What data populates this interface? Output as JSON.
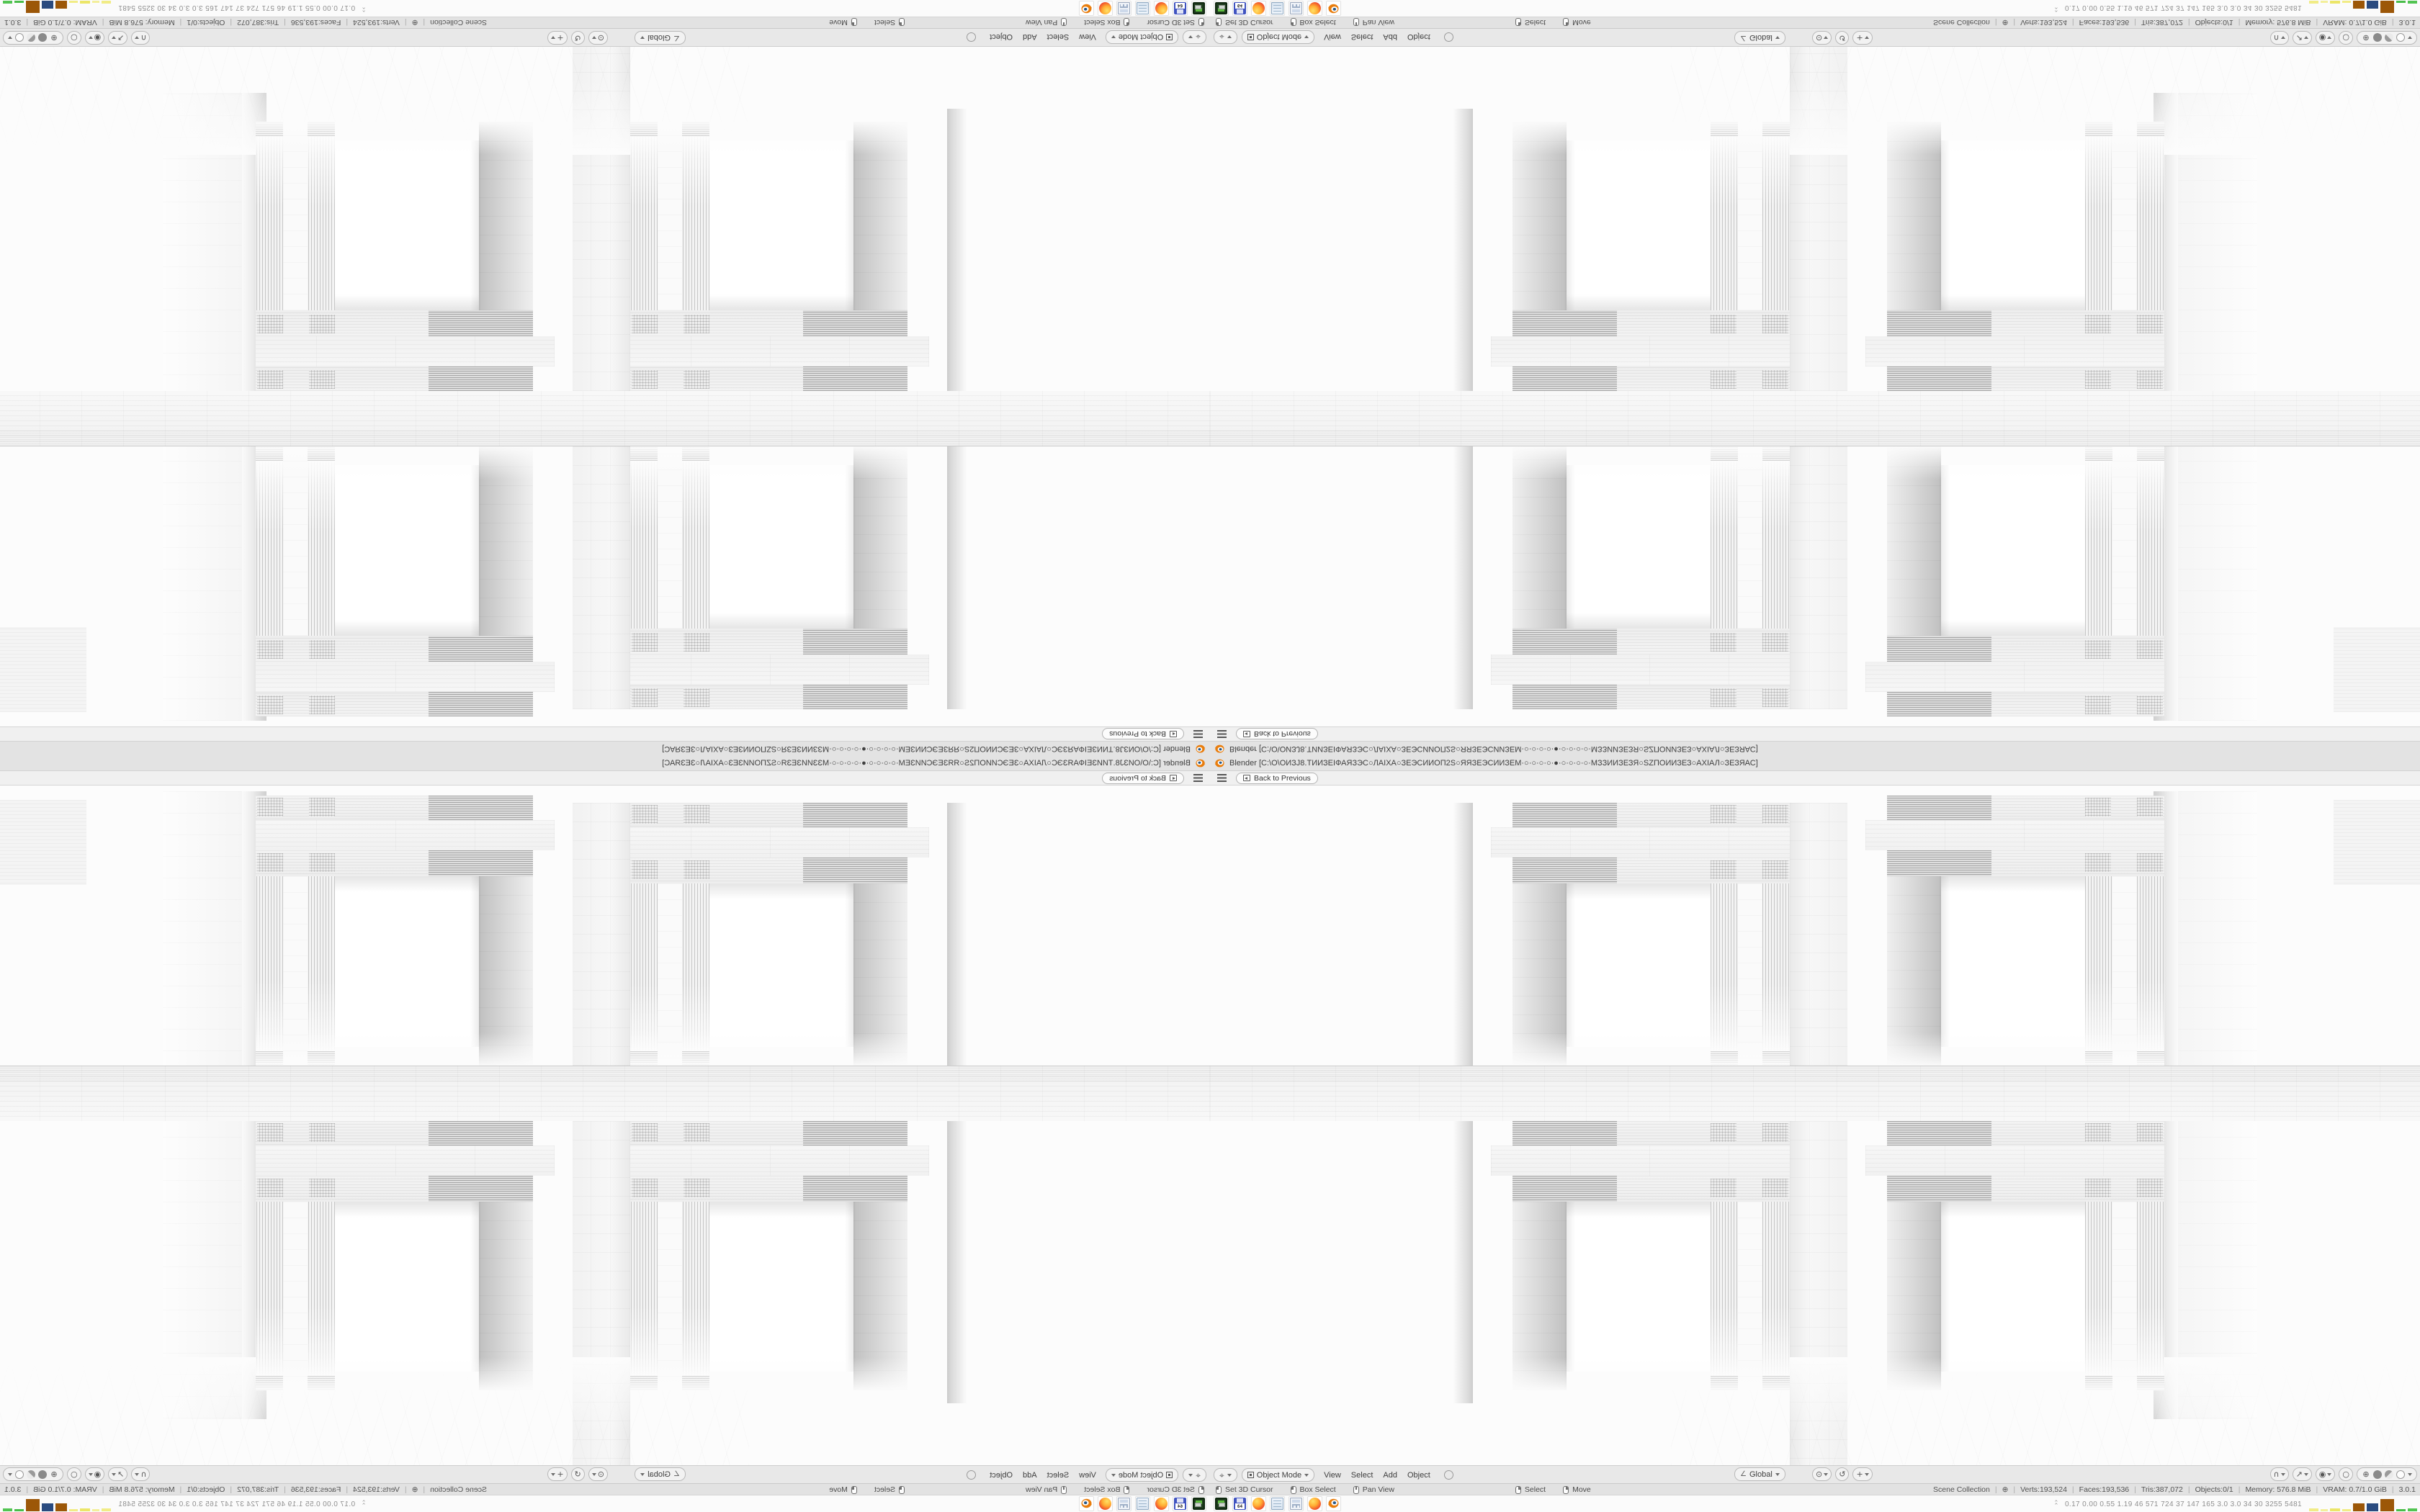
{
  "window": {
    "title": "Blender [C:\\O\\ОИЗЈ8.ТИИЗЕІФАЯЗЭС○ЛАІХА○ЗЕЭСИИОП2S○ЯЯЗЕЭСИИЗЕМ·○·○·○·○·●·○·○·○·○·МЗЗИИЗЕЗЯ○SZПОИИЗЕЗ○АХІАЛ○ЗЕЗЯАС]"
  },
  "topbar": {
    "back_button": "Back to Previous"
  },
  "viewport_header": {
    "editor_icon": "3d-viewport-editor",
    "mode": "Object Mode",
    "menus": [
      "View",
      "Select",
      "Add",
      "Object"
    ],
    "orientation": "Global",
    "pivot_icons": [
      "pivot-point",
      "snap-toggle",
      "proportional-falloff"
    ],
    "tool_icons": [
      "snap-magnet",
      "cursor-tool",
      "proportional-edit",
      "overlay-circle"
    ],
    "shading_modes": [
      "wireframe",
      "solid",
      "material-preview",
      "rendered"
    ]
  },
  "status_bar": {
    "hints": [
      {
        "button": "lmb",
        "label": "Set 3D Cursor"
      },
      {
        "button": "lmb",
        "label": "Box Select"
      },
      {
        "button": "mmb",
        "label": "Pan View",
        "gap_after": true
      },
      {
        "button": "rmb",
        "label": "Select"
      },
      {
        "button": "rmb",
        "label": "Move"
      }
    ],
    "stats": [
      "Scene Collection",
      "⊕",
      "Verts:193,524",
      "Faces:193,536",
      "Tris:387,072",
      "Objects:0/1",
      "Memory: 576.8 MiB",
      "VRAM: 0.7/1.0 GiB",
      "3.0.1"
    ]
  },
  "taskbar": {
    "apps": [
      "drive",
      "floppy",
      "firefox",
      "notepad",
      "calculator",
      "firefox",
      "blender"
    ],
    "floppy_label": "64",
    "perf_values": [
      "0.17",
      "0.00",
      "0.55",
      "1.19",
      "46",
      "571",
      "724",
      "37",
      "147",
      "165",
      "3.0",
      "3.0",
      "34",
      "30",
      "3255",
      "5481"
    ],
    "perf_bars": [
      {
        "color": "#f1ec86",
        "w": 13,
        "h": 4
      },
      {
        "color": "#f3ef9b",
        "w": 10,
        "h": 3
      },
      {
        "color": "#ece668",
        "w": 14,
        "h": 4
      },
      {
        "color": "#f1ec86",
        "w": 12,
        "h": 3
      },
      {
        "color": "#9c5708",
        "w": 16,
        "h": 11
      },
      {
        "color": "#2a4b80",
        "w": 16,
        "h": 11
      },
      {
        "color": "#9c5708",
        "w": 19,
        "h": 17
      },
      {
        "color": "#49bd49",
        "w": 13,
        "h": 3
      },
      {
        "color": "#52c452",
        "w": 13,
        "h": 4
      }
    ]
  },
  "colors": {
    "blender_orange": "#e87d0d",
    "blender_blue": "#265787",
    "ui_gray": "#e8e8e8"
  },
  "composition": {
    "note": "single Blender window mirrored into 2x2 kaleidoscope",
    "quadrants": [
      "rotated-180",
      "flipped-vertical",
      "flipped-horizontal",
      "original"
    ]
  }
}
